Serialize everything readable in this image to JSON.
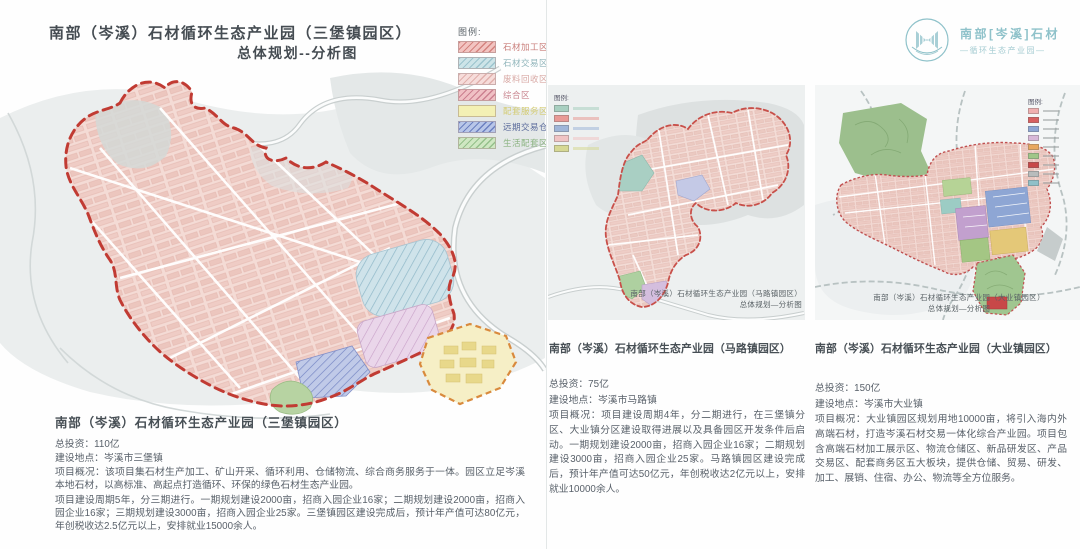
{
  "left_panel": {
    "title_line1": "南部（岑溪）石材循环生态产业园（三堡镇园区）",
    "title_line2": "总体规划--分析图",
    "legend": {
      "title": "图例:",
      "items": [
        {
          "label": "石材加工区",
          "fill": "#f2c4c1",
          "hatch": "#d4827e",
          "text_color": "#c87c78"
        },
        {
          "label": "石材交易区",
          "fill": "#cde4e8",
          "hatch": "#9cc4ce",
          "text_color": "#8fb4ba"
        },
        {
          "label": "废料回收区",
          "fill": "#f6dcda",
          "hatch": "#e0b0ac",
          "text_color": "#d8a8a4"
        },
        {
          "label": "综合区",
          "fill": "#f0c0c4",
          "hatch": "#cc8090",
          "text_color": "#c8848e"
        },
        {
          "label": "配套服务区",
          "fill": "#f3f0b4",
          "hatch": "transparent",
          "text_color": "#d4cc74"
        },
        {
          "label": "远期交易仓储",
          "fill": "#b8c6e8",
          "hatch": "#6c80c0",
          "text_color": "#5c6c9c"
        },
        {
          "label": "生活配套区",
          "fill": "#cfe7c2",
          "hatch": "#94c08a",
          "text_color": "#8cb482"
        }
      ]
    },
    "section": {
      "heading": "南部（岑溪）石材循环生态产业园（三堡镇园区）",
      "investment": "总投资：110亿",
      "location": "建设地点：岑溪市三堡镇",
      "overview": "项目概况：该项目集石材生产加工、矿山开采、循环利用、仓储物流、综合商务服务于一体。园区立足岑溪本地石材，以高标准、高起点打造循环、环保的绿色石材生态产业园。",
      "phases": "项目建设周期5年，分三期进行。一期规划建设2000亩，招商入园企业16家；二期规划建设2000亩，招商入园企业16家；三期规划建设3000亩，招商入园企业25家。三堡镇园区建设完成后，预计年产值可达80亿元，年创税收达2.5亿元以上，安排就业15000余人。"
    }
  },
  "middle_panel": {
    "map_caption_line1": "南部（岑溪）石材循环生态产业园（马路镇园区）",
    "map_caption_line2": "总体规划—分析图",
    "mini_legend_title": "图例:",
    "mini_legend_colors": [
      "#a8cfc0",
      "#e89a96",
      "#9fb6d8",
      "#f0c4c4",
      "#d6d894"
    ],
    "section": {
      "heading": "南部（岑溪）石材循环生态产业园（马路镇园区）",
      "investment": "总投资：75亿",
      "location": "建设地点：岑溪市马路镇",
      "overview": "项目概况：项目建设周期4年，分二期进行，在三堡镇分区、大业镇分区建设取得进展以及具备园区开发条件后启动。一期规划建设2000亩，招商入园企业16家；二期规划建设3000亩，招商入园企业25家。马路镇园区建设完成后，预计年产值可达50亿元，年创税收达2亿元以上，安排就业10000余人。"
    }
  },
  "right_panel": {
    "logo": {
      "name_line1": "南部[岑溪]石材",
      "name_line2": "—循环生态产业园—",
      "color": "#8fc2ca"
    },
    "map_caption_line1": "南部（岑溪）石材循环生态产业园（大业镇园区）",
    "map_caption_line2": "总体规划—分析图",
    "mini_legend_title": "图例:",
    "mini_legend_colors": [
      "#f0b0b0",
      "#d86060",
      "#8ea6d4",
      "#d8b8d8",
      "#e8a860",
      "#a0c688",
      "#c84848",
      "#b8bcbc",
      "#90c0c8"
    ],
    "section": {
      "heading": "南部（岑溪）石材循环生态产业园（大业镇园区）",
      "investment": "总投资：150亿",
      "location": "建设地点：岑溪市大业镇",
      "overview": "项目概况：大业镇园区规划用地10000亩，将引入海内外高端石材，打造岑溪石材交易一体化综合产业园。项目包含高端石材加工展示区、物流仓储区、新品研发区、产品交易区、配套商务区五大板块，提供仓储、贸易、研发、加工、展销、住宿、办公、物流等全方位服务。"
    }
  },
  "colors": {
    "boundary_red": "#c13b33",
    "boundary_orange": "#d98a3d",
    "park_pink": "#f4dbd5",
    "accent_teal": "#8fc2ca"
  }
}
